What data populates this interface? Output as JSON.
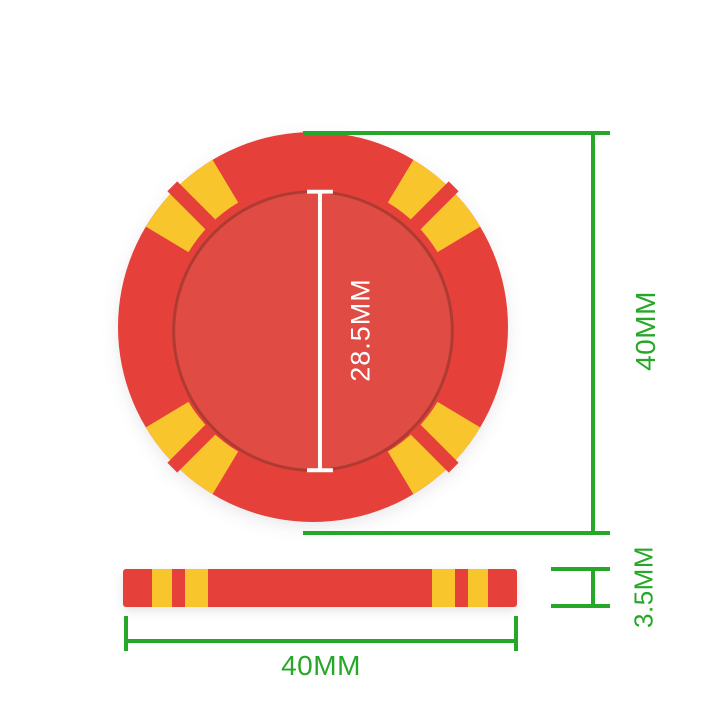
{
  "labels": {
    "inner_diameter": "28.5MM",
    "outer_diameter_right": "40MM",
    "thickness": "3.5MM",
    "outer_width_bottom": "40MM"
  },
  "colors": {
    "chip_red": "#E6403A",
    "chip_inner_red": "#E04B43",
    "chip_ring_brown": "#A53A30",
    "chip_yellow": "#F9C52D",
    "dimension_green": "#27A727",
    "measure_line_white": "#FFFFFF",
    "background": "#FFFFFF"
  }
}
